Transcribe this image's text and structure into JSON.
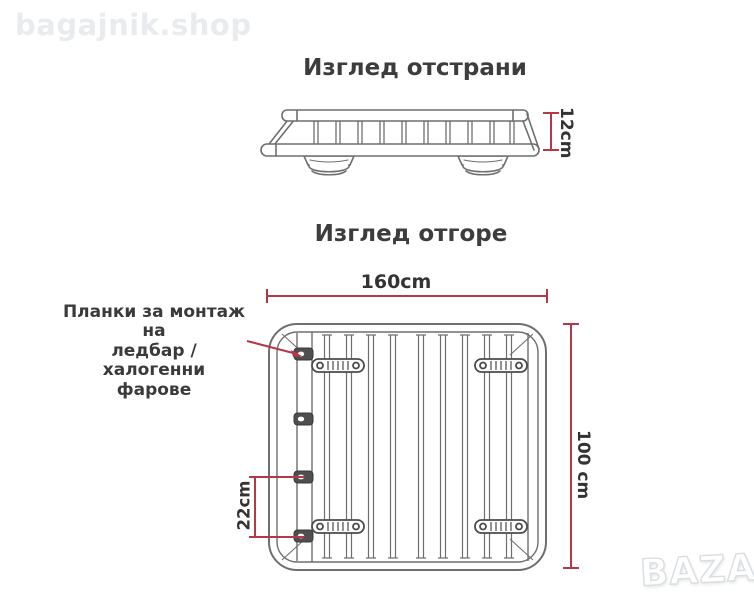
{
  "watermarks": {
    "shop_name": "bagajnik.shop",
    "marketplace_logo": "BAZAR"
  },
  "side_view": {
    "title": "Изглед отстрани",
    "height_dimension": "12cm"
  },
  "top_view": {
    "title": "Изглед отгоре",
    "width_dimension": "160cm",
    "length_dimension": "100 cm",
    "tab_spacing_dimension": "22cm",
    "mount_annotation": {
      "lines": [
        "Планки за монтаж на",
        "ледбар / халогенни",
        "фарове"
      ]
    }
  },
  "colors": {
    "dimension_red": "#b5374a",
    "drawing_gray": "#6f6f6f",
    "bracket_dark": "#4b4b4b",
    "text_dark": "#3a3a3a",
    "watermark_light": "#e8ecef",
    "background": "#ffffff"
  }
}
